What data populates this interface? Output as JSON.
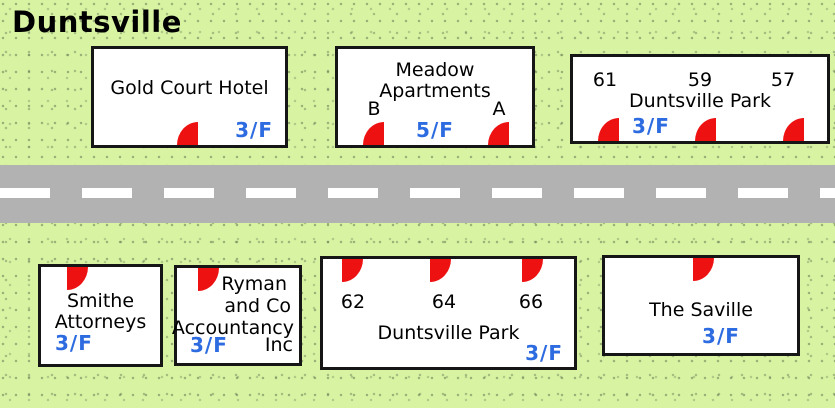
{
  "title": "Duntsville",
  "colors": {
    "background": "#d8f4a2",
    "road": "#b2b2b2",
    "lane_marking": "#ffffff",
    "building_fill": "#ffffff",
    "building_border": "#161616",
    "door_marker": "#ee1111",
    "floor_label": "#2d6be0"
  },
  "buildings": [
    {
      "name": "Gold Court Hotel",
      "floor": "3/F",
      "entrances": 1
    },
    {
      "name": "Meadow Apartments",
      "floor": "5/F",
      "units": [
        "B",
        "A"
      ],
      "entrances": 2
    },
    {
      "name": "Duntsville Park",
      "floor": "3/F",
      "units": [
        "61",
        "59",
        "57"
      ],
      "entrances": 3
    },
    {
      "name_lines": [
        "Smithe",
        "Attorneys"
      ],
      "floor": "3/F",
      "entrances": 1
    },
    {
      "name_lines": [
        "Ryman",
        "and Co",
        "Accountancy"
      ],
      "name_suffix": "Inc",
      "floor": "3/F",
      "entrances": 1
    },
    {
      "name": "Duntsville Park",
      "floor": "3/F",
      "units": [
        "62",
        "64",
        "66"
      ],
      "entrances": 3
    },
    {
      "name": "The Saville",
      "floor": "3/F",
      "entrances": 1
    }
  ]
}
